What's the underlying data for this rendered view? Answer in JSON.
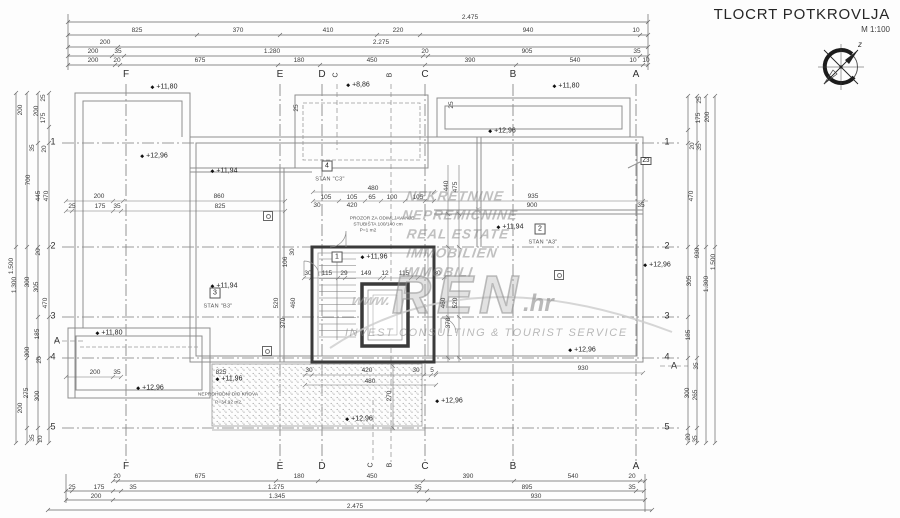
{
  "title_block": {
    "title": "TLOCRT POTKROVLJA",
    "scale": "M 1:100",
    "compass_label": "z"
  },
  "watermark": {
    "www": "www.",
    "brand": "REN",
    "brand_suffix": ".hr",
    "tagline": "INVEST CONSULTING & TOURIST SERVICE",
    "lines_pos": [
      {
        "x": 455,
        "y": 196,
        "t": "NEKRETNINE"
      },
      {
        "x": 460,
        "y": 215,
        "t": "NEPREMIČNINE"
      },
      {
        "x": 458,
        "y": 234,
        "t": "REAL ESTATE"
      },
      {
        "x": 452,
        "y": 253,
        "t": "IMMOBILIEN"
      },
      {
        "x": 438,
        "y": 272,
        "t": "IMMOBILI"
      }
    ]
  },
  "grid": {
    "top_letters": [
      {
        "x": 126,
        "y": 75,
        "t": "F"
      },
      {
        "x": 280,
        "y": 75,
        "t": "E"
      },
      {
        "x": 322,
        "y": 75,
        "t": "D"
      },
      {
        "x": 425,
        "y": 75,
        "t": "C"
      },
      {
        "x": 513,
        "y": 75,
        "t": "B"
      },
      {
        "x": 636,
        "y": 75,
        "t": "A"
      }
    ],
    "top_letters_rotated": [
      {
        "x": 336,
        "y": 75,
        "t": "C"
      },
      {
        "x": 390,
        "y": 75,
        "t": "B"
      }
    ],
    "bottom_letters": [
      {
        "x": 126,
        "y": 467,
        "t": "F"
      },
      {
        "x": 280,
        "y": 467,
        "t": "E"
      },
      {
        "x": 322,
        "y": 467,
        "t": "D"
      },
      {
        "x": 425,
        "y": 467,
        "t": "C"
      },
      {
        "x": 513,
        "y": 467,
        "t": "B"
      },
      {
        "x": 636,
        "y": 467,
        "t": "A"
      }
    ],
    "bottom_letters_rotated": [
      {
        "x": 371,
        "y": 465,
        "t": "C"
      },
      {
        "x": 390,
        "y": 465,
        "t": "B"
      }
    ],
    "left_numbers": [
      {
        "x": 53,
        "y": 142,
        "t": "1"
      },
      {
        "x": 53,
        "y": 246,
        "t": "2"
      },
      {
        "x": 53,
        "y": 316,
        "t": "3"
      },
      {
        "x": 53,
        "y": 357,
        "t": "4"
      },
      {
        "x": 53,
        "y": 427,
        "t": "5"
      }
    ],
    "right_numbers": [
      {
        "x": 667,
        "y": 142,
        "t": "1"
      },
      {
        "x": 667,
        "y": 246,
        "t": "2"
      },
      {
        "x": 667,
        "y": 316,
        "t": "3"
      },
      {
        "x": 667,
        "y": 357,
        "t": "4"
      },
      {
        "x": 667,
        "y": 427,
        "t": "5"
      }
    ],
    "section_markers": [
      {
        "x": 57,
        "y": 341,
        "t": "A"
      },
      {
        "x": 674,
        "y": 366,
        "t": "A"
      }
    ]
  },
  "dimensions": {
    "top": [
      {
        "x": 470,
        "y": 18,
        "t": "2.475"
      },
      {
        "x": 137,
        "y": 31,
        "t": "825"
      },
      {
        "x": 238,
        "y": 31,
        "t": "370"
      },
      {
        "x": 328,
        "y": 31,
        "t": "410"
      },
      {
        "x": 398,
        "y": 31,
        "t": "220"
      },
      {
        "x": 528,
        "y": 31,
        "t": "940"
      },
      {
        "x": 636,
        "y": 31,
        "t": "10"
      },
      {
        "x": 105,
        "y": 43,
        "t": "200"
      },
      {
        "x": 381,
        "y": 43,
        "t": "2.275"
      },
      {
        "x": 93,
        "y": 52,
        "t": "200"
      },
      {
        "x": 118,
        "y": 52,
        "t": "35"
      },
      {
        "x": 272,
        "y": 52,
        "t": "1.280"
      },
      {
        "x": 425,
        "y": 52,
        "t": "20"
      },
      {
        "x": 527,
        "y": 52,
        "t": "905"
      },
      {
        "x": 637,
        "y": 52,
        "t": "35"
      },
      {
        "x": 93,
        "y": 61,
        "t": "200"
      },
      {
        "x": 117,
        "y": 61,
        "t": "20"
      },
      {
        "x": 200,
        "y": 61,
        "t": "675"
      },
      {
        "x": 299,
        "y": 61,
        "t": "180"
      },
      {
        "x": 372,
        "y": 61,
        "t": "450"
      },
      {
        "x": 470,
        "y": 61,
        "t": "390"
      },
      {
        "x": 575,
        "y": 61,
        "t": "540"
      },
      {
        "x": 633,
        "y": 61,
        "t": "10"
      },
      {
        "x": 646,
        "y": 61,
        "t": "10"
      }
    ],
    "bottom": [
      {
        "x": 117,
        "y": 477,
        "t": "20"
      },
      {
        "x": 200,
        "y": 477,
        "t": "675"
      },
      {
        "x": 299,
        "y": 477,
        "t": "180"
      },
      {
        "x": 372,
        "y": 477,
        "t": "450"
      },
      {
        "x": 468,
        "y": 477,
        "t": "390"
      },
      {
        "x": 573,
        "y": 477,
        "t": "540"
      },
      {
        "x": 632,
        "y": 477,
        "t": "20"
      },
      {
        "x": 72,
        "y": 488,
        "t": "25"
      },
      {
        "x": 99,
        "y": 488,
        "t": "175"
      },
      {
        "x": 133,
        "y": 488,
        "t": "35"
      },
      {
        "x": 276,
        "y": 488,
        "t": "1.275"
      },
      {
        "x": 418,
        "y": 488,
        "t": "35"
      },
      {
        "x": 527,
        "y": 488,
        "t": "895"
      },
      {
        "x": 632,
        "y": 488,
        "t": "35"
      },
      {
        "x": 96,
        "y": 497,
        "t": "200"
      },
      {
        "x": 277,
        "y": 497,
        "t": "1.345"
      },
      {
        "x": 536,
        "y": 497,
        "t": "930"
      },
      {
        "x": 355,
        "y": 507,
        "t": "2.475"
      }
    ],
    "left": [
      {
        "x": 21,
        "y": 110,
        "t": "200"
      },
      {
        "x": 37,
        "y": 111,
        "t": "200"
      },
      {
        "x": 44,
        "y": 98,
        "t": "25"
      },
      {
        "x": 44,
        "y": 118,
        "t": "175"
      },
      {
        "x": 33,
        "y": 148,
        "t": "35"
      },
      {
        "x": 45,
        "y": 149,
        "t": "20"
      },
      {
        "x": 29,
        "y": 180,
        "t": "700"
      },
      {
        "x": 39,
        "y": 196,
        "t": "445"
      },
      {
        "x": 47,
        "y": 196,
        "t": "470"
      },
      {
        "x": 39,
        "y": 252,
        "t": "20"
      },
      {
        "x": 12,
        "y": 266,
        "t": "1.500"
      },
      {
        "x": 15,
        "y": 285,
        "t": "1.300"
      },
      {
        "x": 28,
        "y": 282,
        "t": "300"
      },
      {
        "x": 37,
        "y": 287,
        "t": "305"
      },
      {
        "x": 46,
        "y": 303,
        "t": "470"
      },
      {
        "x": 38,
        "y": 334,
        "t": "185"
      },
      {
        "x": 28,
        "y": 352,
        "t": "300"
      },
      {
        "x": 40,
        "y": 360,
        "t": "20"
      },
      {
        "x": 27,
        "y": 393,
        "t": "275"
      },
      {
        "x": 38,
        "y": 396,
        "t": "300"
      },
      {
        "x": 21,
        "y": 408,
        "t": "200"
      },
      {
        "x": 33,
        "y": 438,
        "t": "35"
      },
      {
        "x": 41,
        "y": 439,
        "t": "20"
      }
    ],
    "right": [
      {
        "x": 700,
        "y": 100,
        "t": "25"
      },
      {
        "x": 708,
        "y": 117,
        "t": "200"
      },
      {
        "x": 699,
        "y": 118,
        "t": "175"
      },
      {
        "x": 693,
        "y": 146,
        "t": "20"
      },
      {
        "x": 700,
        "y": 147,
        "t": "35"
      },
      {
        "x": 692,
        "y": 196,
        "t": "470"
      },
      {
        "x": 698,
        "y": 253,
        "t": "930"
      },
      {
        "x": 714,
        "y": 262,
        "t": "1.500"
      },
      {
        "x": 690,
        "y": 281,
        "t": "305"
      },
      {
        "x": 707,
        "y": 284,
        "t": "1.300"
      },
      {
        "x": 689,
        "y": 335,
        "t": "185"
      },
      {
        "x": 697,
        "y": 366,
        "t": "35"
      },
      {
        "x": 688,
        "y": 393,
        "t": "300"
      },
      {
        "x": 696,
        "y": 395,
        "t": "265"
      },
      {
        "x": 689,
        "y": 437,
        "t": "20"
      },
      {
        "x": 696,
        "y": 439,
        "t": "35"
      }
    ],
    "interior": [
      {
        "x": 99,
        "y": 197,
        "t": "200"
      },
      {
        "x": 219,
        "y": 197,
        "t": "860"
      },
      {
        "x": 72,
        "y": 207,
        "t": "25"
      },
      {
        "x": 100,
        "y": 207,
        "t": "175"
      },
      {
        "x": 117,
        "y": 207,
        "t": "35"
      },
      {
        "x": 220,
        "y": 207,
        "t": "825"
      },
      {
        "x": 373,
        "y": 189,
        "t": "480"
      },
      {
        "x": 326,
        "y": 198,
        "t": "105"
      },
      {
        "x": 352,
        "y": 198,
        "t": "105"
      },
      {
        "x": 372,
        "y": 198,
        "t": "65"
      },
      {
        "x": 392,
        "y": 198,
        "t": "100"
      },
      {
        "x": 418,
        "y": 198,
        "t": "105"
      },
      {
        "x": 317,
        "y": 206,
        "t": "30"
      },
      {
        "x": 352,
        "y": 206,
        "t": "420"
      },
      {
        "x": 533,
        "y": 197,
        "t": "935"
      },
      {
        "x": 532,
        "y": 206,
        "t": "900"
      },
      {
        "x": 641,
        "y": 206,
        "t": "35"
      },
      {
        "x": 308,
        "y": 274,
        "t": "30"
      },
      {
        "x": 327,
        "y": 274,
        "t": "115"
      },
      {
        "x": 344,
        "y": 274,
        "t": "29"
      },
      {
        "x": 366,
        "y": 274,
        "t": "149"
      },
      {
        "x": 385,
        "y": 274,
        "t": "12"
      },
      {
        "x": 404,
        "y": 274,
        "t": "115"
      },
      {
        "x": 437,
        "y": 274,
        "t": "30"
      },
      {
        "x": 309,
        "y": 371,
        "t": "30"
      },
      {
        "x": 367,
        "y": 371,
        "t": "420"
      },
      {
        "x": 416,
        "y": 371,
        "t": "30"
      },
      {
        "x": 432,
        "y": 371,
        "t": "5"
      },
      {
        "x": 583,
        "y": 369,
        "t": "930"
      },
      {
        "x": 95,
        "y": 373,
        "t": "200"
      },
      {
        "x": 117,
        "y": 373,
        "t": "35"
      },
      {
        "x": 221,
        "y": 373,
        "t": "825"
      },
      {
        "x": 370,
        "y": 382,
        "t": "480"
      }
    ],
    "interior_rotated": [
      {
        "x": 297,
        "y": 108,
        "t": "25"
      },
      {
        "x": 452,
        "y": 105,
        "t": "25"
      },
      {
        "x": 286,
        "y": 262,
        "t": "106"
      },
      {
        "x": 293,
        "y": 252,
        "t": "30"
      },
      {
        "x": 277,
        "y": 303,
        "t": "520"
      },
      {
        "x": 294,
        "y": 303,
        "t": "460"
      },
      {
        "x": 284,
        "y": 323,
        "t": "370"
      },
      {
        "x": 447,
        "y": 186,
        "t": "440"
      },
      {
        "x": 456,
        "y": 187,
        "t": "475"
      },
      {
        "x": 444,
        "y": 303,
        "t": "460"
      },
      {
        "x": 456,
        "y": 303,
        "t": "520"
      },
      {
        "x": 449,
        "y": 323,
        "t": "370"
      },
      {
        "x": 390,
        "y": 396,
        "t": "270"
      }
    ]
  },
  "elevations": [
    {
      "x": 164,
      "y": 87,
      "t": "+11,80"
    },
    {
      "x": 358,
      "y": 85,
      "t": "+8,86"
    },
    {
      "x": 566,
      "y": 86,
      "t": "+11,80"
    },
    {
      "x": 154,
      "y": 156,
      "t": "+12,96"
    },
    {
      "x": 224,
      "y": 171,
      "t": "+11,94"
    },
    {
      "x": 502,
      "y": 131,
      "t": "+12,96"
    },
    {
      "x": 510,
      "y": 227,
      "t": "+11,94"
    },
    {
      "x": 657,
      "y": 265,
      "t": "+12,96"
    },
    {
      "x": 374,
      "y": 257,
      "t": "+11,96"
    },
    {
      "x": 224,
      "y": 286,
      "t": "+11,94"
    },
    {
      "x": 109,
      "y": 333,
      "t": "+11,80"
    },
    {
      "x": 582,
      "y": 350,
      "t": "+12,96"
    },
    {
      "x": 150,
      "y": 388,
      "t": "+12,96"
    },
    {
      "x": 229,
      "y": 379,
      "t": "+11,96"
    },
    {
      "x": 449,
      "y": 401,
      "t": "+12,96"
    },
    {
      "x": 359,
      "y": 419,
      "t": "+12,96"
    }
  ],
  "rooms": {
    "numbers": [
      {
        "x": 327,
        "y": 166,
        "t": "4"
      },
      {
        "x": 540,
        "y": 229,
        "t": "2"
      },
      {
        "x": 337,
        "y": 257,
        "t": "1"
      },
      {
        "x": 215,
        "y": 293,
        "t": "3"
      }
    ],
    "names": [
      {
        "x": 330,
        "y": 180,
        "t": "STAN \"C3\""
      },
      {
        "x": 543,
        "y": 243,
        "t": "STAN \"A3\""
      },
      {
        "x": 218,
        "y": 307,
        "t": "STAN \"B3\""
      }
    ]
  },
  "tags": [
    {
      "x": 646,
      "y": 161,
      "t": "Z3"
    }
  ],
  "notes": {
    "stair_window": [
      {
        "x": 382,
        "y": 220,
        "t": "PROZOR ZA ODIMLJAVANJE"
      },
      {
        "x": 378,
        "y": 226,
        "t": "STUBIŠTA 100/140 cm"
      },
      {
        "x": 368,
        "y": 232,
        "t": "P=1 m2"
      }
    ],
    "roof": [
      {
        "x": 228,
        "y": 396,
        "t": "NEPROHODNI DIO KROVA"
      },
      {
        "x": 228,
        "y": 404,
        "t": "P=34,92 m2"
      }
    ]
  },
  "drains": [
    {
      "x": 268,
      "y": 216
    },
    {
      "x": 267,
      "y": 351
    },
    {
      "x": 559,
      "y": 275
    }
  ],
  "colors": {
    "line": "#8f8f8f",
    "wall_dark": "#3a3a3a",
    "grid": "#7a7a7a",
    "watermark": "#9a9a9a"
  }
}
